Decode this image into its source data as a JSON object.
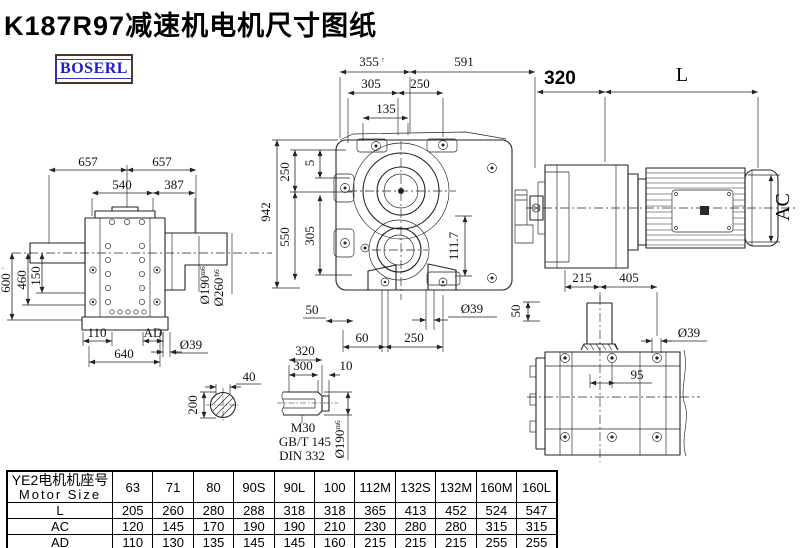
{
  "title": "K187R97减速机电机尺寸图纸",
  "logo_text": "BOSERL",
  "colors": {
    "line": "#232323",
    "logo_text": "#1e1ecf",
    "logo_border": "#4b3529"
  },
  "dims": {
    "left": {
      "w1": "657",
      "w2": "657",
      "w3": "540",
      "w4": "387",
      "h1": "600",
      "h1s": "′",
      "h2": "460",
      "h3": "150",
      "b1": "110",
      "b2": "AD",
      "b3": "640",
      "b4": "Ø39",
      "s1": "Ø190",
      "s1t": "m6",
      "s2": "Ø260",
      "s2t": "h6"
    },
    "front": {
      "t1": "355",
      "t1s": "↑",
      "t2": "591",
      "t3": "305",
      "t4": "250",
      "t5": "135",
      "l1": "942",
      "l2": "250",
      "l3": "5",
      "l4": "550",
      "l5": "305",
      "b1": "50",
      "b2": "60",
      "b3": "250",
      "b4": "Ø39",
      "r1": "50",
      "r2": "111.7"
    },
    "side": {
      "t1": "320",
      "t2": "L",
      "r1": "AC",
      "b1": "215",
      "b2": "405"
    },
    "key": {
      "w": "40",
      "h": "200"
    },
    "shaft": {
      "t1": "320",
      "t2": "300",
      "t3": "10",
      "l1": "M30",
      "l2": "GB/T 145",
      "l3": "DIN 332",
      "d1": "Ø190",
      "d1t": "m6"
    },
    "flange": {
      "d1": "Ø39",
      "d2": "95"
    }
  },
  "table": {
    "header_cn": "YE2电机机座号",
    "header_en": "Motor Size",
    "columns": [
      "63",
      "71",
      "80",
      "90S",
      "90L",
      "100",
      "112M",
      "132S",
      "132M",
      "160M",
      "160L"
    ],
    "rows": [
      {
        "label": "L",
        "values": [
          "205",
          "260",
          "280",
          "288",
          "318",
          "318",
          "365",
          "413",
          "452",
          "524",
          "547"
        ]
      },
      {
        "label": "AC",
        "values": [
          "120",
          "145",
          "170",
          "190",
          "190",
          "210",
          "230",
          "280",
          "280",
          "315",
          "315"
        ]
      },
      {
        "label": "AD",
        "values": [
          "110",
          "130",
          "135",
          "145",
          "145",
          "160",
          "215",
          "215",
          "215",
          "255",
          "255"
        ]
      }
    ]
  }
}
